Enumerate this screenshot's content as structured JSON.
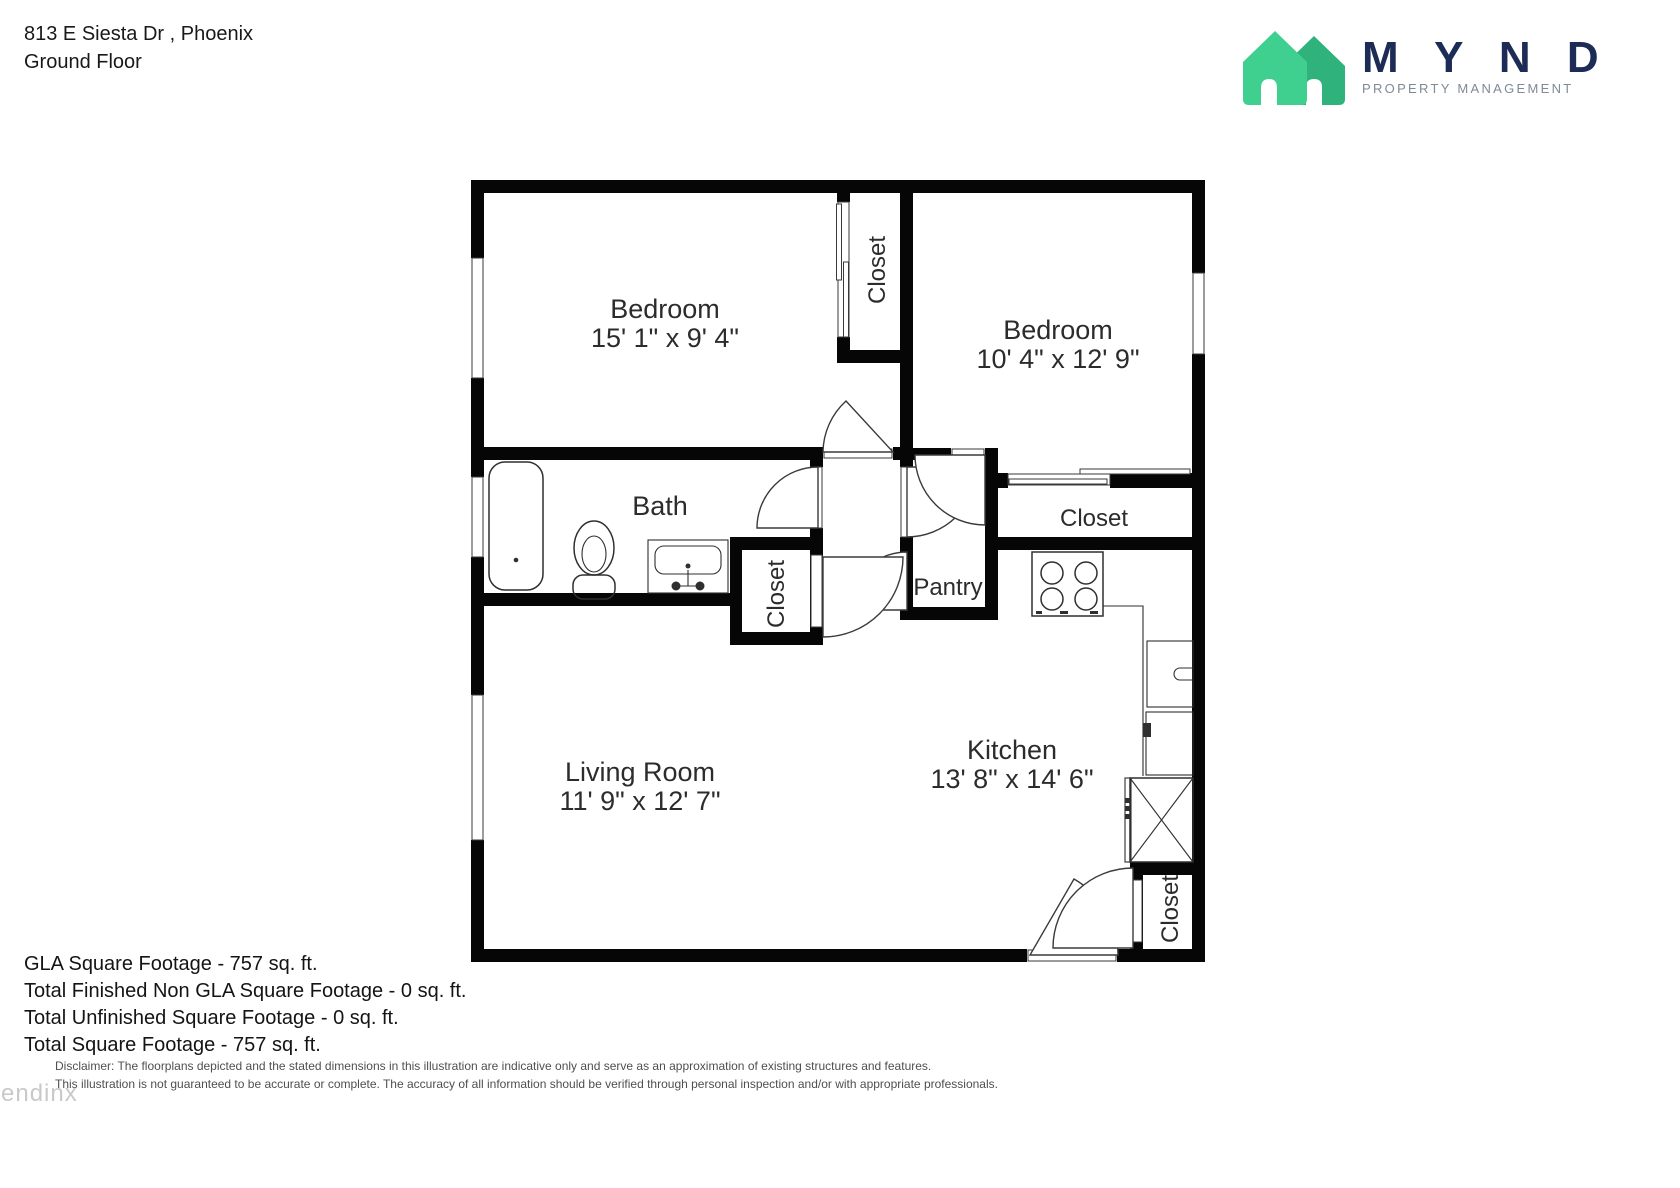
{
  "header": {
    "address": "813 E Siesta Dr , Phoenix",
    "floor": "Ground Floor"
  },
  "logo": {
    "word": "M Y N D",
    "tagline": "PROPERTY MANAGEMENT",
    "house_light_color": "#3fd08f",
    "house_dark_color": "#2fb27c",
    "word_color": "#1d2c56"
  },
  "rooms": {
    "bedroom1": {
      "name": "Bedroom",
      "dims": "15' 1\" x 9' 4\""
    },
    "bedroom2": {
      "name": "Bedroom",
      "dims": "10' 4\" x 12' 9\""
    },
    "bath": {
      "name": "Bath"
    },
    "living": {
      "name": "Living Room",
      "dims": "11' 9\" x 12' 7\""
    },
    "kitchen": {
      "name": "Kitchen",
      "dims": "13' 8\" x 14' 6\""
    },
    "pantry": {
      "name": "Pantry"
    },
    "closet_between_bedrooms": {
      "name": "Closet"
    },
    "closet_hall": {
      "name": "Closet"
    },
    "closet_bedroom2": {
      "name": "Closet"
    },
    "closet_entry": {
      "name": "Closet"
    }
  },
  "footer": {
    "lines": [
      "GLA Square Footage - 757 sq. ft.",
      "Total Finished Non GLA Square Footage - 0 sq. ft.",
      "Total Unfinished Square Footage - 0 sq. ft.",
      "Total Square Footage - 757 sq. ft."
    ]
  },
  "disclaimer": {
    "line1": "Disclaimer: The floorplans depicted and the stated dimensions in this illustration are indicative only and serve as an approximation of existing structures and features.",
    "line2": "This illustration is not guaranteed to be accurate or complete. The accuracy of all information should be verified through personal inspection and/or with appropriate professionals."
  },
  "watermark": "rendinx"
}
